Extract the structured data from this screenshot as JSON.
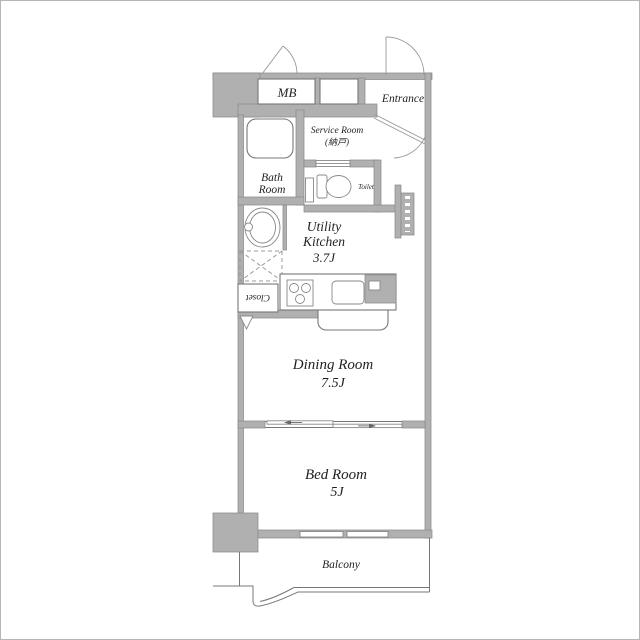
{
  "colors": {
    "wall": "#b0b0b0",
    "wall_edge": "#8a8a8a",
    "line": "#777777",
    "text": "#1f1f1f"
  },
  "rooms": {
    "mb": {
      "label": "MB"
    },
    "entrance": {
      "label": "Entrance"
    },
    "service_room": {
      "label_en": "Service Room",
      "label_jp": "(納戸)"
    },
    "bath_room": {
      "label_line1": "Bath",
      "label_line2": "Room"
    },
    "toilet": {
      "label": "Toilet"
    },
    "utility_kitchen": {
      "label_line1": "Utility",
      "label_line2": "Kitchen",
      "size": "3.7J"
    },
    "dining_room": {
      "label": "Dining Room",
      "size": "7.5J"
    },
    "bed_room": {
      "label": "Bed Room",
      "size": "5J"
    },
    "balcony": {
      "label": "Balcony"
    },
    "closet": {
      "label": "Closet"
    }
  }
}
